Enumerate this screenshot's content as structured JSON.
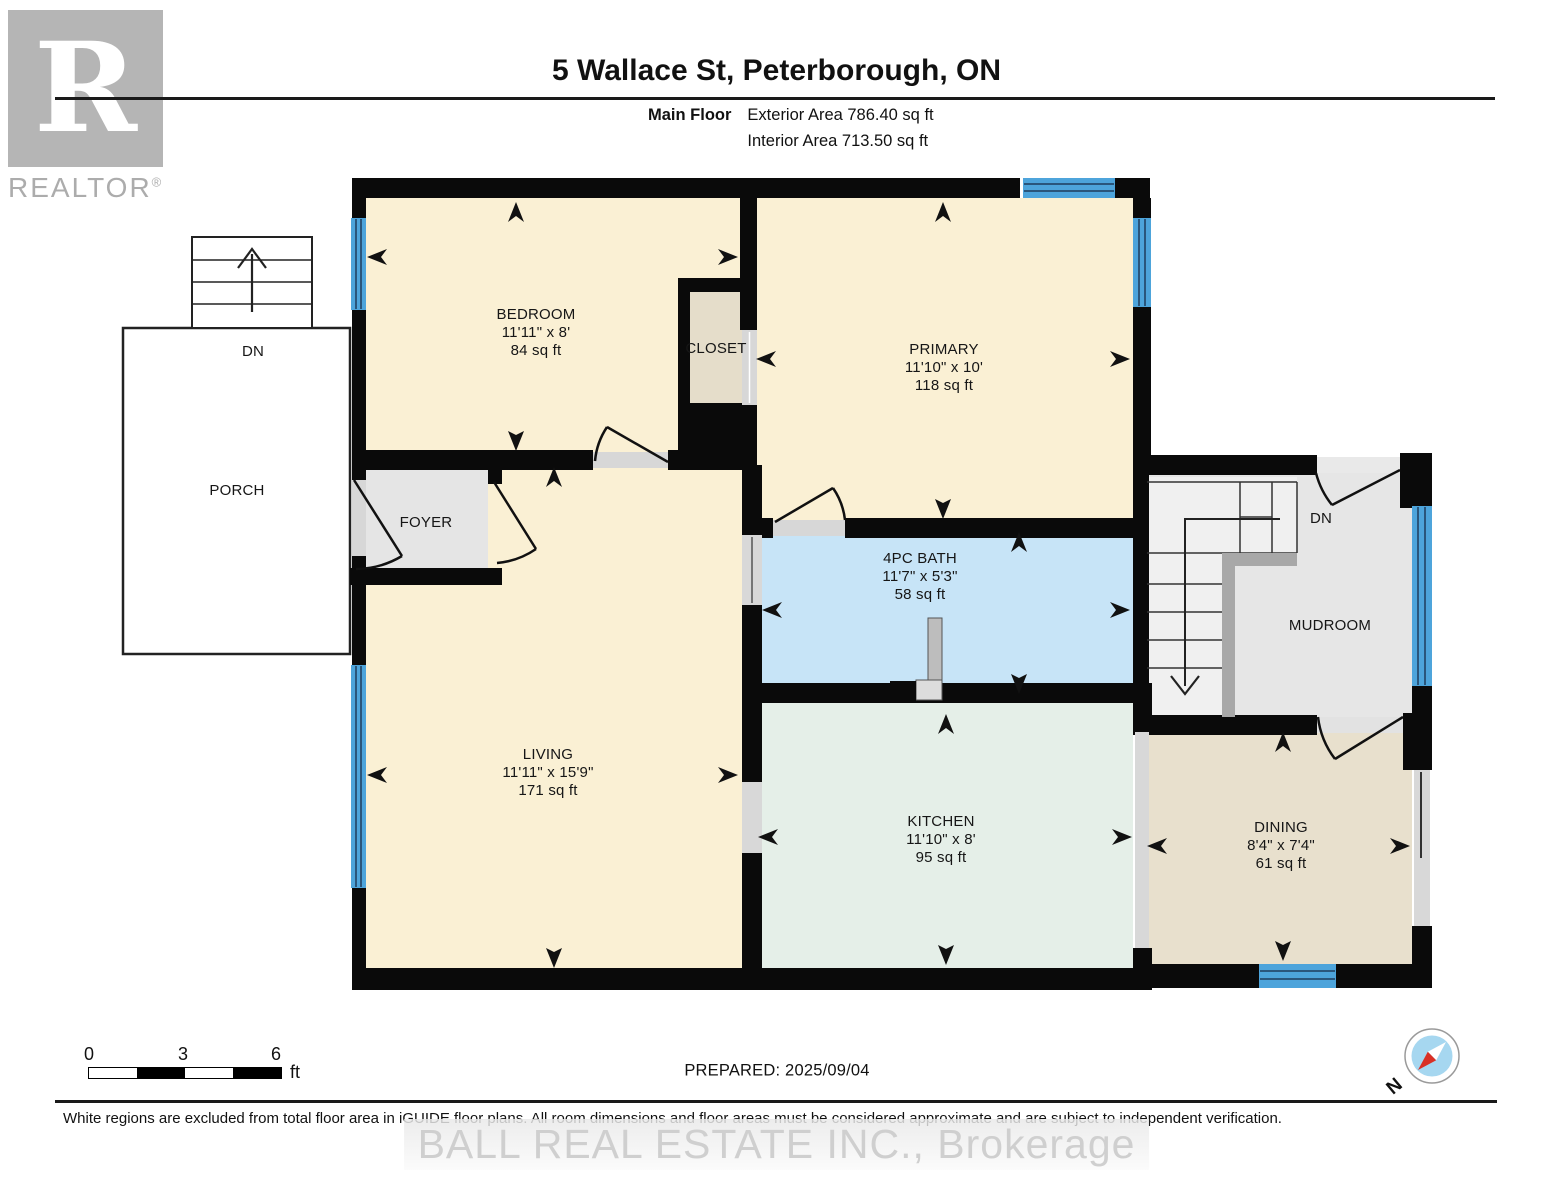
{
  "header": {
    "title": "5 Wallace St, Peterborough, ON",
    "floor_label": "Main Floor",
    "exterior_area": "Exterior Area 786.40 sq ft",
    "interior_area": "Interior Area 713.50 sq ft"
  },
  "logo": {
    "letter": "R",
    "brand": "REALTOR",
    "registered": "®"
  },
  "rooms": {
    "bedroom": {
      "name": "BEDROOM",
      "dims": "11'11\" x 8'",
      "area": "84 sq ft"
    },
    "primary": {
      "name": "PRIMARY",
      "dims": "11'10\" x 10'",
      "area": "118 sq ft"
    },
    "bath": {
      "name": "4PC BATH",
      "dims": "11'7\" x 5'3\"",
      "area": "58 sq ft"
    },
    "living": {
      "name": "LIVING",
      "dims": "11'11\" x 15'9\"",
      "area": "171 sq ft"
    },
    "kitchen": {
      "name": "KITCHEN",
      "dims": "11'10\" x 8'",
      "area": "95 sq ft"
    },
    "dining": {
      "name": "DINING",
      "dims": "8'4\" x 7'4\"",
      "area": "61 sq ft"
    },
    "closet": {
      "name": "CLOSET"
    },
    "foyer": {
      "name": "FOYER"
    },
    "mudroom": {
      "name": "MUDROOM"
    },
    "porch": {
      "name": "PORCH"
    }
  },
  "stairs": {
    "porch_label": "DN",
    "mudroom_label": "DN"
  },
  "scale_bar": {
    "tick_0": "0",
    "tick_3": "3",
    "tick_6": "6",
    "unit": "ft"
  },
  "compass": {
    "north_label": "N"
  },
  "footer": {
    "prepared": "PREPARED: 2025/09/04",
    "disclaimer": "White regions are excluded from total floor area in iGUIDE floor plans. All room dimensions and floor areas must be considered approximate and are subject to independent verification.",
    "watermark": "BALL REAL ESTATE INC., Brokerage"
  },
  "colors": {
    "room_cream": "#FAF0D4",
    "room_tan": "#E8E0CD",
    "closet_tan": "#E5DDCA",
    "bath_blue": "#C7E4F7",
    "kitchen_green": "#E5EFE8",
    "gray_room": "#E6E6E6",
    "window_blue": "#4DA4DB",
    "wall_black": "#0A0A0A",
    "compass_red": "#D93025"
  }
}
